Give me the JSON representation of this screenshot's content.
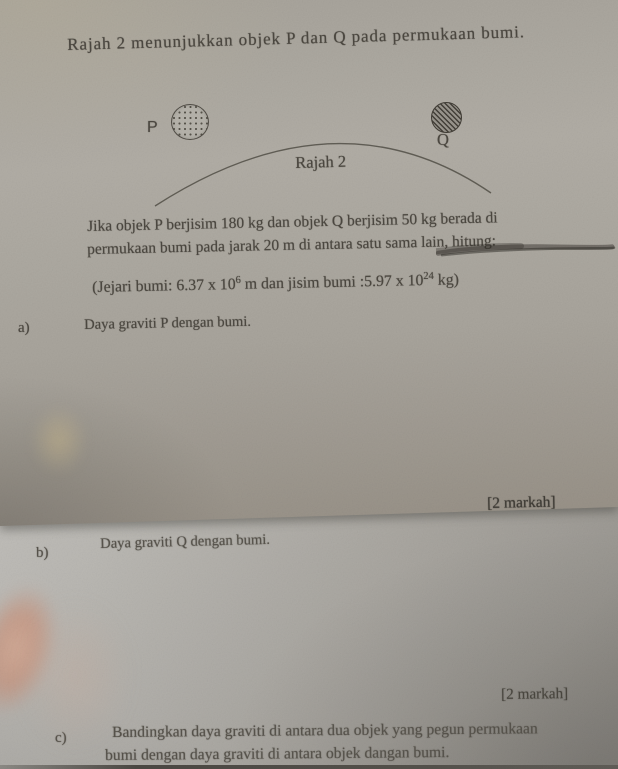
{
  "page": {
    "title": "Rajah 2 menunjukkan objek P dan Q pada permukaan bumi.",
    "diagram": {
      "label_p": "P",
      "label_q": "Q",
      "caption": "Rajah 2",
      "object_p_pattern": "dotted-circle",
      "object_q_pattern": "hatched-circle"
    },
    "question": {
      "line1": "Jika objek P berjisim 180 kg dan objek Q berjisim 50 kg berada di",
      "line2": "permukaan bumi pada jarak 20 m di antara satu sama lain, hitung:"
    },
    "given": {
      "part1": "(Jejari bumi: 6.37 x 10",
      "sup1": "6",
      "part2": " m dan jisim bumi :5.97 x 10",
      "sup2": "24",
      "part3": " kg)"
    },
    "items": {
      "a": {
        "label": "a)",
        "text": "Daya graviti P dengan bumi.",
        "marks": "[2 markah]"
      },
      "b": {
        "label": "b)",
        "text": "Daya graviti Q dengan bumi.",
        "marks": "[2 markah]"
      },
      "c": {
        "label": "c)",
        "line1": "Bandingkan daya graviti di antara dua objek yang pegun permukaan",
        "line2": "bumi dengan daya graviti di antara objek dangan bumi."
      }
    },
    "colors": {
      "paper_top": "#aba79f",
      "paper_bottom": "#c4c2bd",
      "ink": "#4c4841"
    }
  }
}
